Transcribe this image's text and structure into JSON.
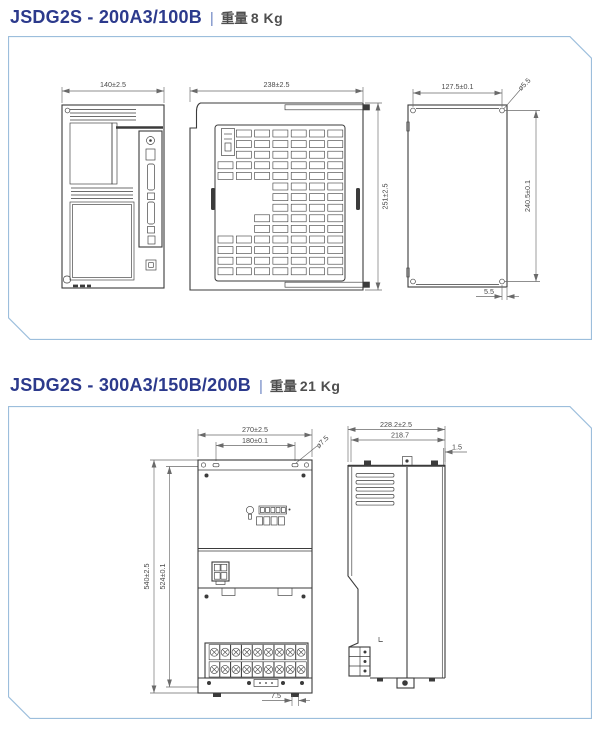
{
  "colors": {
    "title": "#2c3a8c",
    "separator": "#6f87c4",
    "weight_text": "#4f4f4f",
    "panel_border": "#9cbedc",
    "drawing_line": "#3b3b3b",
    "dim_line": "#6a6a6a"
  },
  "sections": [
    {
      "model": "JSDG2S - 200A3/100B",
      "separator": "|",
      "weight_label": "重量",
      "weight": "8 Kg",
      "dims": {
        "front_width": "140±2.5",
        "side_width": "238±2.5",
        "side_height": "251±2.5",
        "mount_width": "127.5±0.1",
        "mount_hole": "ø5.5",
        "mount_height": "240.5±0.1",
        "mount_edge": "5.5"
      }
    },
    {
      "model": "JSDG2S - 300A3/150B/200B",
      "separator": "|",
      "weight_label": "重量",
      "weight": "21 Kg",
      "dims": {
        "front_width": "270±2.5",
        "mount_width": "180±0.1",
        "mount_hole": "ø7.5",
        "front_height": "540±2.5",
        "mount_height": "524±0.1",
        "bottom_offset": "7.5",
        "side_depth": "228.2±2.5",
        "side_depth2": "218.7",
        "lip": "1.5"
      }
    }
  ]
}
